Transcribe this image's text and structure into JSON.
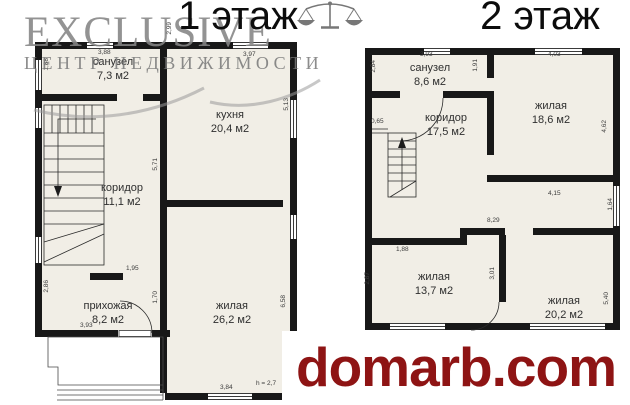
{
  "watermark": {
    "brand": "EXCLUSIVE",
    "tagline": "ЦЕНТР НЕДВИЖИМОСТИ"
  },
  "site": {
    "label": "domarb.com"
  },
  "colors": {
    "brand_red": "#8e1414",
    "wall_black": "#181818",
    "floor_cream": "#f1eee6",
    "watermark_gray": "#858585"
  },
  "floor1": {
    "title": "1 этаж",
    "rooms": {
      "sanuzel": {
        "name": "санузел",
        "area": "7,3 м2"
      },
      "kitchen": {
        "name": "кухня",
        "area": "20,4 м2"
      },
      "corridor": {
        "name": "коридор",
        "area": "11,1 м2"
      },
      "hallway": {
        "name": "прихожая",
        "area": "8,2 м2"
      },
      "living": {
        "name": "жилая",
        "area": "26,2 м2"
      }
    },
    "dims": {
      "sanuzel_top": "3,88",
      "sanuzel_left": "1,88",
      "mid_top": "2,99",
      "kitchen_top": "3,97",
      "kitchen_right": "5,13",
      "corridor_wall": "5,71",
      "door_opening": "1,95",
      "living_left": "1,70",
      "left_bottom": "2,86",
      "hallway_bottom": "3,93",
      "living_right": "6,58",
      "living_bottom": "3,84",
      "ceiling_height": "h = 2,7"
    }
  },
  "floor2": {
    "title": "2 этаж",
    "rooms": {
      "sanuzel": {
        "name": "санузел",
        "area": "8,6 м2"
      },
      "corridor": {
        "name": "коридор",
        "area": "17,5 м2"
      },
      "living1": {
        "name": "жилая",
        "area": "18,6 м2"
      },
      "living2": {
        "name": "жилая",
        "area": "13,7 м2"
      },
      "living3": {
        "name": "жилая",
        "area": "20,2 м2"
      }
    },
    "dims": {
      "sanuzel_top": "3,93",
      "sanuzel_left": "2,84",
      "sanuzel_right": "1,91",
      "living1_top": "4,03",
      "stairs_wall": "0,65",
      "living1_right": "4,62",
      "living1_bottom": "4,15",
      "right_mid": "1,64",
      "lower_width": "8,29",
      "living2_top": "1,88",
      "living2_left": "2,87",
      "living2_right": "3,01",
      "living3_right": "5,40"
    }
  }
}
